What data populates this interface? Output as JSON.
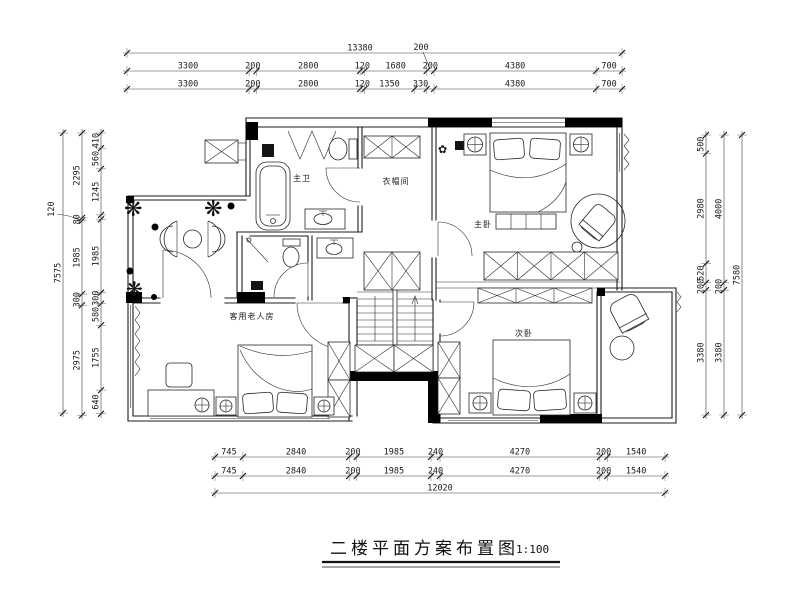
{
  "title": {
    "text": "二楼平面方案布置图",
    "scale": "1:100"
  },
  "rooms": {
    "master_bath": "主卫",
    "cloakroom": "衣帽间",
    "master_bedroom": "主卧",
    "second_bedroom": "次卧",
    "guest_elder_room": "客用老人房"
  },
  "dimensions": {
    "top": {
      "total_row": [
        13380
      ],
      "detached_label": "200",
      "row2": [
        3300,
        200,
        2800,
        120,
        1680,
        200,
        4380,
        700
      ],
      "row3": [
        3300,
        200,
        2800,
        120,
        1350,
        330,
        200,
        4380,
        700
      ]
    },
    "bottom": {
      "row1": [
        745,
        2840,
        200,
        1985,
        240,
        4270,
        200,
        1540
      ],
      "row2": [
        745,
        2840,
        200,
        1985,
        240,
        4270,
        200,
        1540
      ],
      "total_row": [
        12020
      ]
    },
    "left": {
      "outer": [
        7575
      ],
      "middle": [
        2295,
        80,
        1985,
        300,
        2975
      ],
      "inner": [
        410,
        560,
        1245,
        120,
        1985,
        300,
        580,
        1755,
        640
      ],
      "detached_label": "120"
    },
    "right": {
      "inner": [
        500,
        2980,
        520,
        200,
        3380
      ],
      "middle": [
        4000,
        200,
        3380
      ],
      "outer": [
        7580
      ]
    }
  }
}
